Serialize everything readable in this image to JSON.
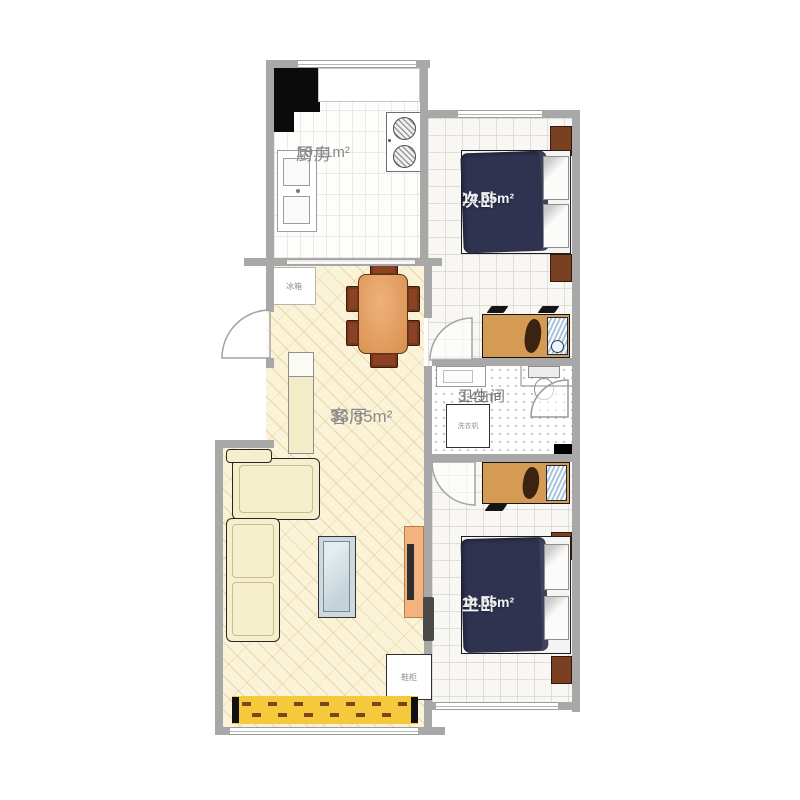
{
  "plan": {
    "rooms": {
      "kitchen": {
        "name": "厨房",
        "area": "10.11m²"
      },
      "secondary_bedroom": {
        "name": "次卧",
        "area": "14.05m²"
      },
      "living_room": {
        "name": "客厅",
        "area": "33.85m²"
      },
      "bathroom": {
        "name": "卫生间",
        "area": "3.49m²"
      },
      "master_bedroom": {
        "name": "主卧",
        "area": "14.05m²"
      }
    },
    "labels": {
      "fridge": "冰箱",
      "washing_machine": "洗衣机",
      "shoe_cabinet": "鞋柜"
    },
    "colors": {
      "wall": "#a8a8a8",
      "living_floor": "#fbf3d7",
      "bed": "#2f3350",
      "wood_chair": "#8a4124",
      "desk": "#d59a54",
      "rug": "#f6c83c",
      "tv_stand": "#f3b381",
      "sofa": "#f6efcd"
    }
  }
}
